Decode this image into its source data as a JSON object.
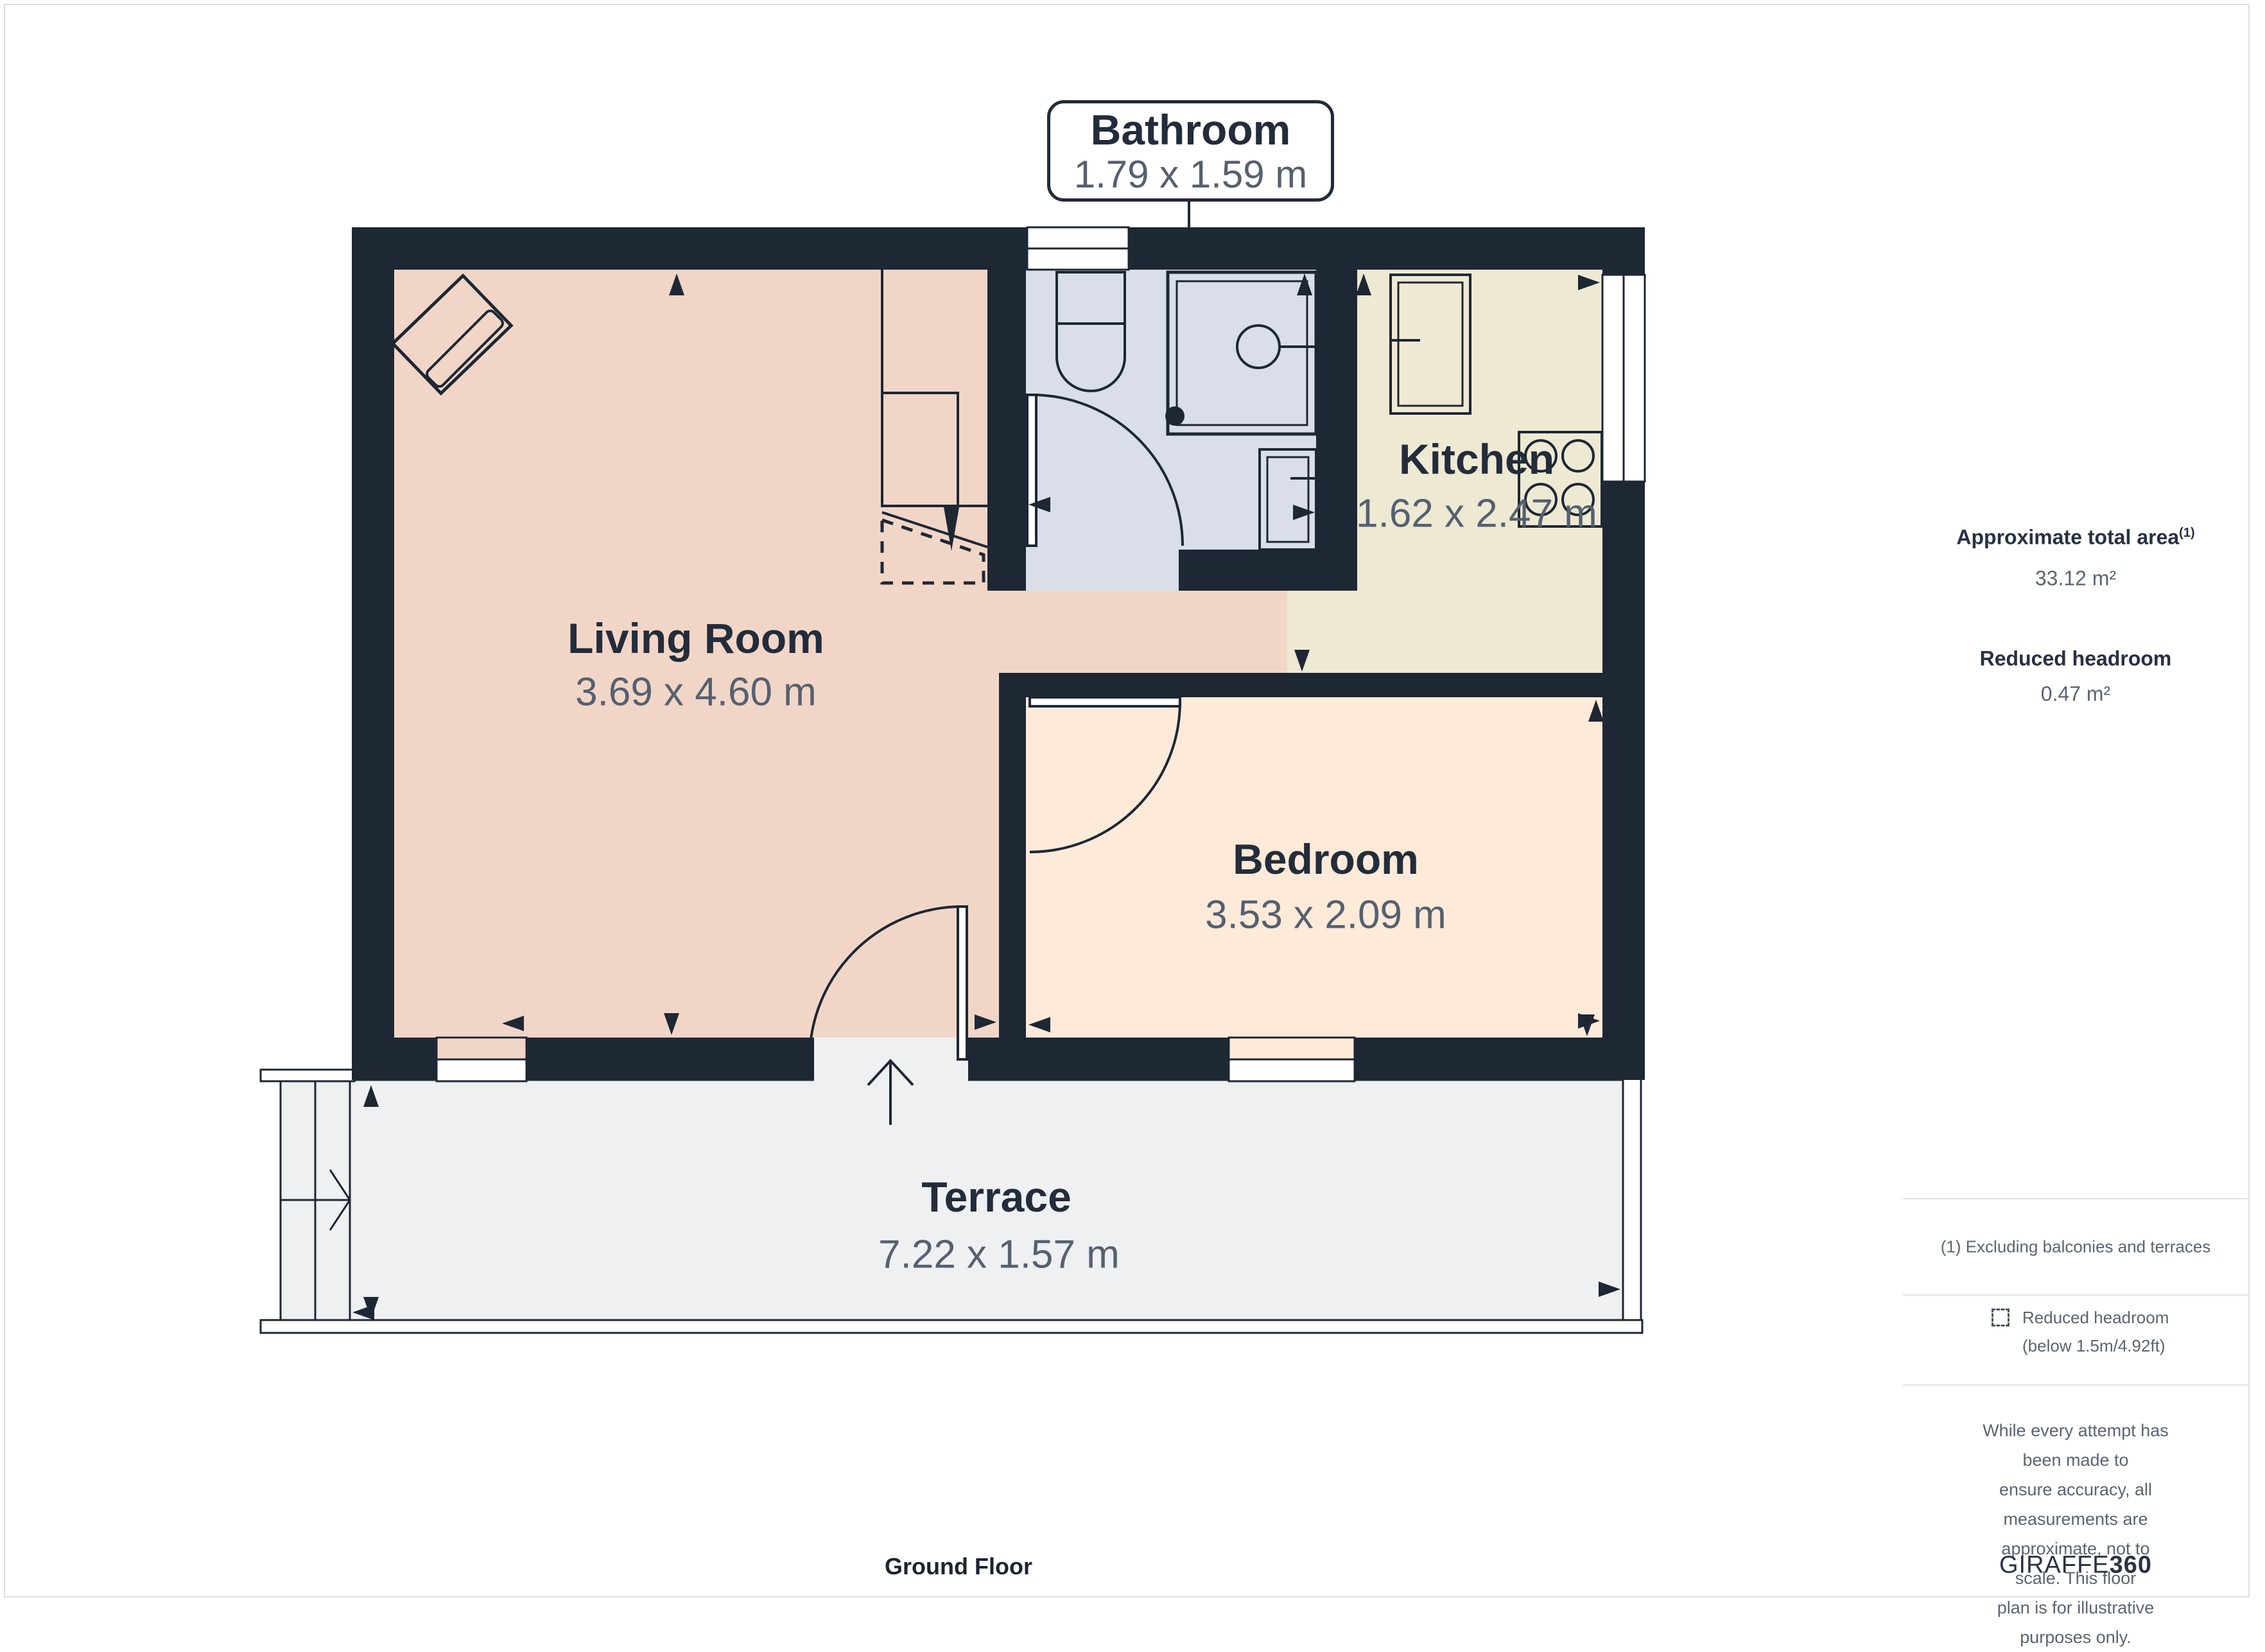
{
  "title": "Ground Floor",
  "callout": {
    "name": "Bathroom",
    "dims": "1.79 x 1.59 m"
  },
  "rooms": {
    "living": {
      "name": "Living Room",
      "dims": "3.69 x 4.60 m"
    },
    "kitchen": {
      "name": "Kitchen",
      "dims": "1.62 x 2.47 m"
    },
    "bedroom": {
      "name": "Bedroom",
      "dims": "3.53 x 2.09 m"
    },
    "terrace": {
      "name": "Terrace",
      "dims": "7.22 x 1.57 m"
    }
  },
  "sidebar": {
    "total_area_label": "Approximate total area",
    "total_area_sup": "(1)",
    "total_area_value": "33.12 m²",
    "reduced_headroom_label": "Reduced headroom",
    "reduced_headroom_value": "0.47 m²",
    "footnote": "(1) Excluding balconies and terraces",
    "legend_line1": "Reduced headroom",
    "legend_line2": "(below 1.5m/4.92ft)",
    "disclaimer_lines": [
      "While every attempt has been made to",
      "ensure accuracy, all measurements are",
      "approximate, not to scale. This floor",
      "plan is for illustrative purposes only."
    ],
    "brand_regular": "GIRAFFE",
    "brand_bold": "360"
  },
  "colors": {
    "wall": "#1e2734",
    "living": "#f1d6c7",
    "bedroom": "#fdead9",
    "kitchen": "#eee9d3",
    "bathroom": "#d9dee9",
    "terrace": "#eef0f2",
    "window": "#ffffff"
  }
}
